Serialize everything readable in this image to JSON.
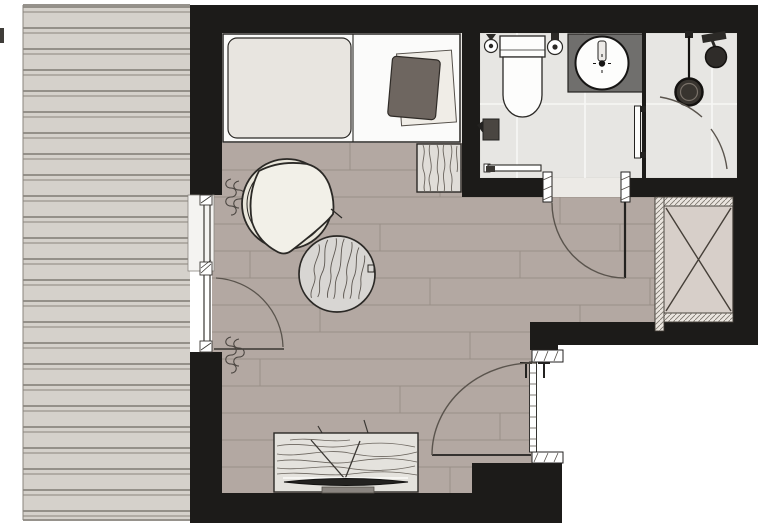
{
  "meta": {
    "title": "Room floor plan with terrace, sleeping alcove, bathroom and shower",
    "canvas_width": 758,
    "canvas_height": 524
  },
  "colors": {
    "wall": "#1c1b19",
    "outline": "#2b2926",
    "terrace_bg": "#d5d1cb",
    "terrace_line": "#7f7a73",
    "bedroom_floor": "#eae8e4",
    "bed_linen": "#fbfbfa",
    "duvet": "#e8e5e0",
    "pillow": "#6e6660",
    "pillow_sheet": "#f0ede7",
    "main_floor": "#b3a8a2",
    "plank_line": "#998f88",
    "bath_floor": "#e7e6e3",
    "grout": "#f7f7f5",
    "threshold": "#eceae6",
    "vanity_top": "#706f6d",
    "porcelain": "#fdfdfc",
    "fixture_dark": "#2f2c29",
    "wood_light": "#e0ddd8",
    "wood_grain": "#6b655e",
    "stool": "#d8d6d3",
    "sideboard": "#e4e2dd",
    "wardrobe": "#d7cfc9",
    "wardrobe_hatch": "#eae5df",
    "armchair_back": "#e9e6db",
    "armchair_seat": "#f2f0e8",
    "tv": "#232220",
    "door_arc": "#5a544d",
    "outside": "#ffffff"
  },
  "legend": [
    "terrace-decking",
    "exterior-wall",
    "window-with-balcony-door",
    "curtains",
    "double-bed",
    "duvet",
    "pillow",
    "foot-bench",
    "armchair",
    "wooden-side-stool",
    "tv-sideboard",
    "tv",
    "wardrobe",
    "entrance-door",
    "bathroom-door",
    "toilet",
    "toilet-roll-holder",
    "toilet-brush",
    "waste-bin",
    "towel-rail",
    "washbasin-vanity",
    "shower-partition",
    "shower-handle",
    "floor-drain",
    "shower-head"
  ]
}
